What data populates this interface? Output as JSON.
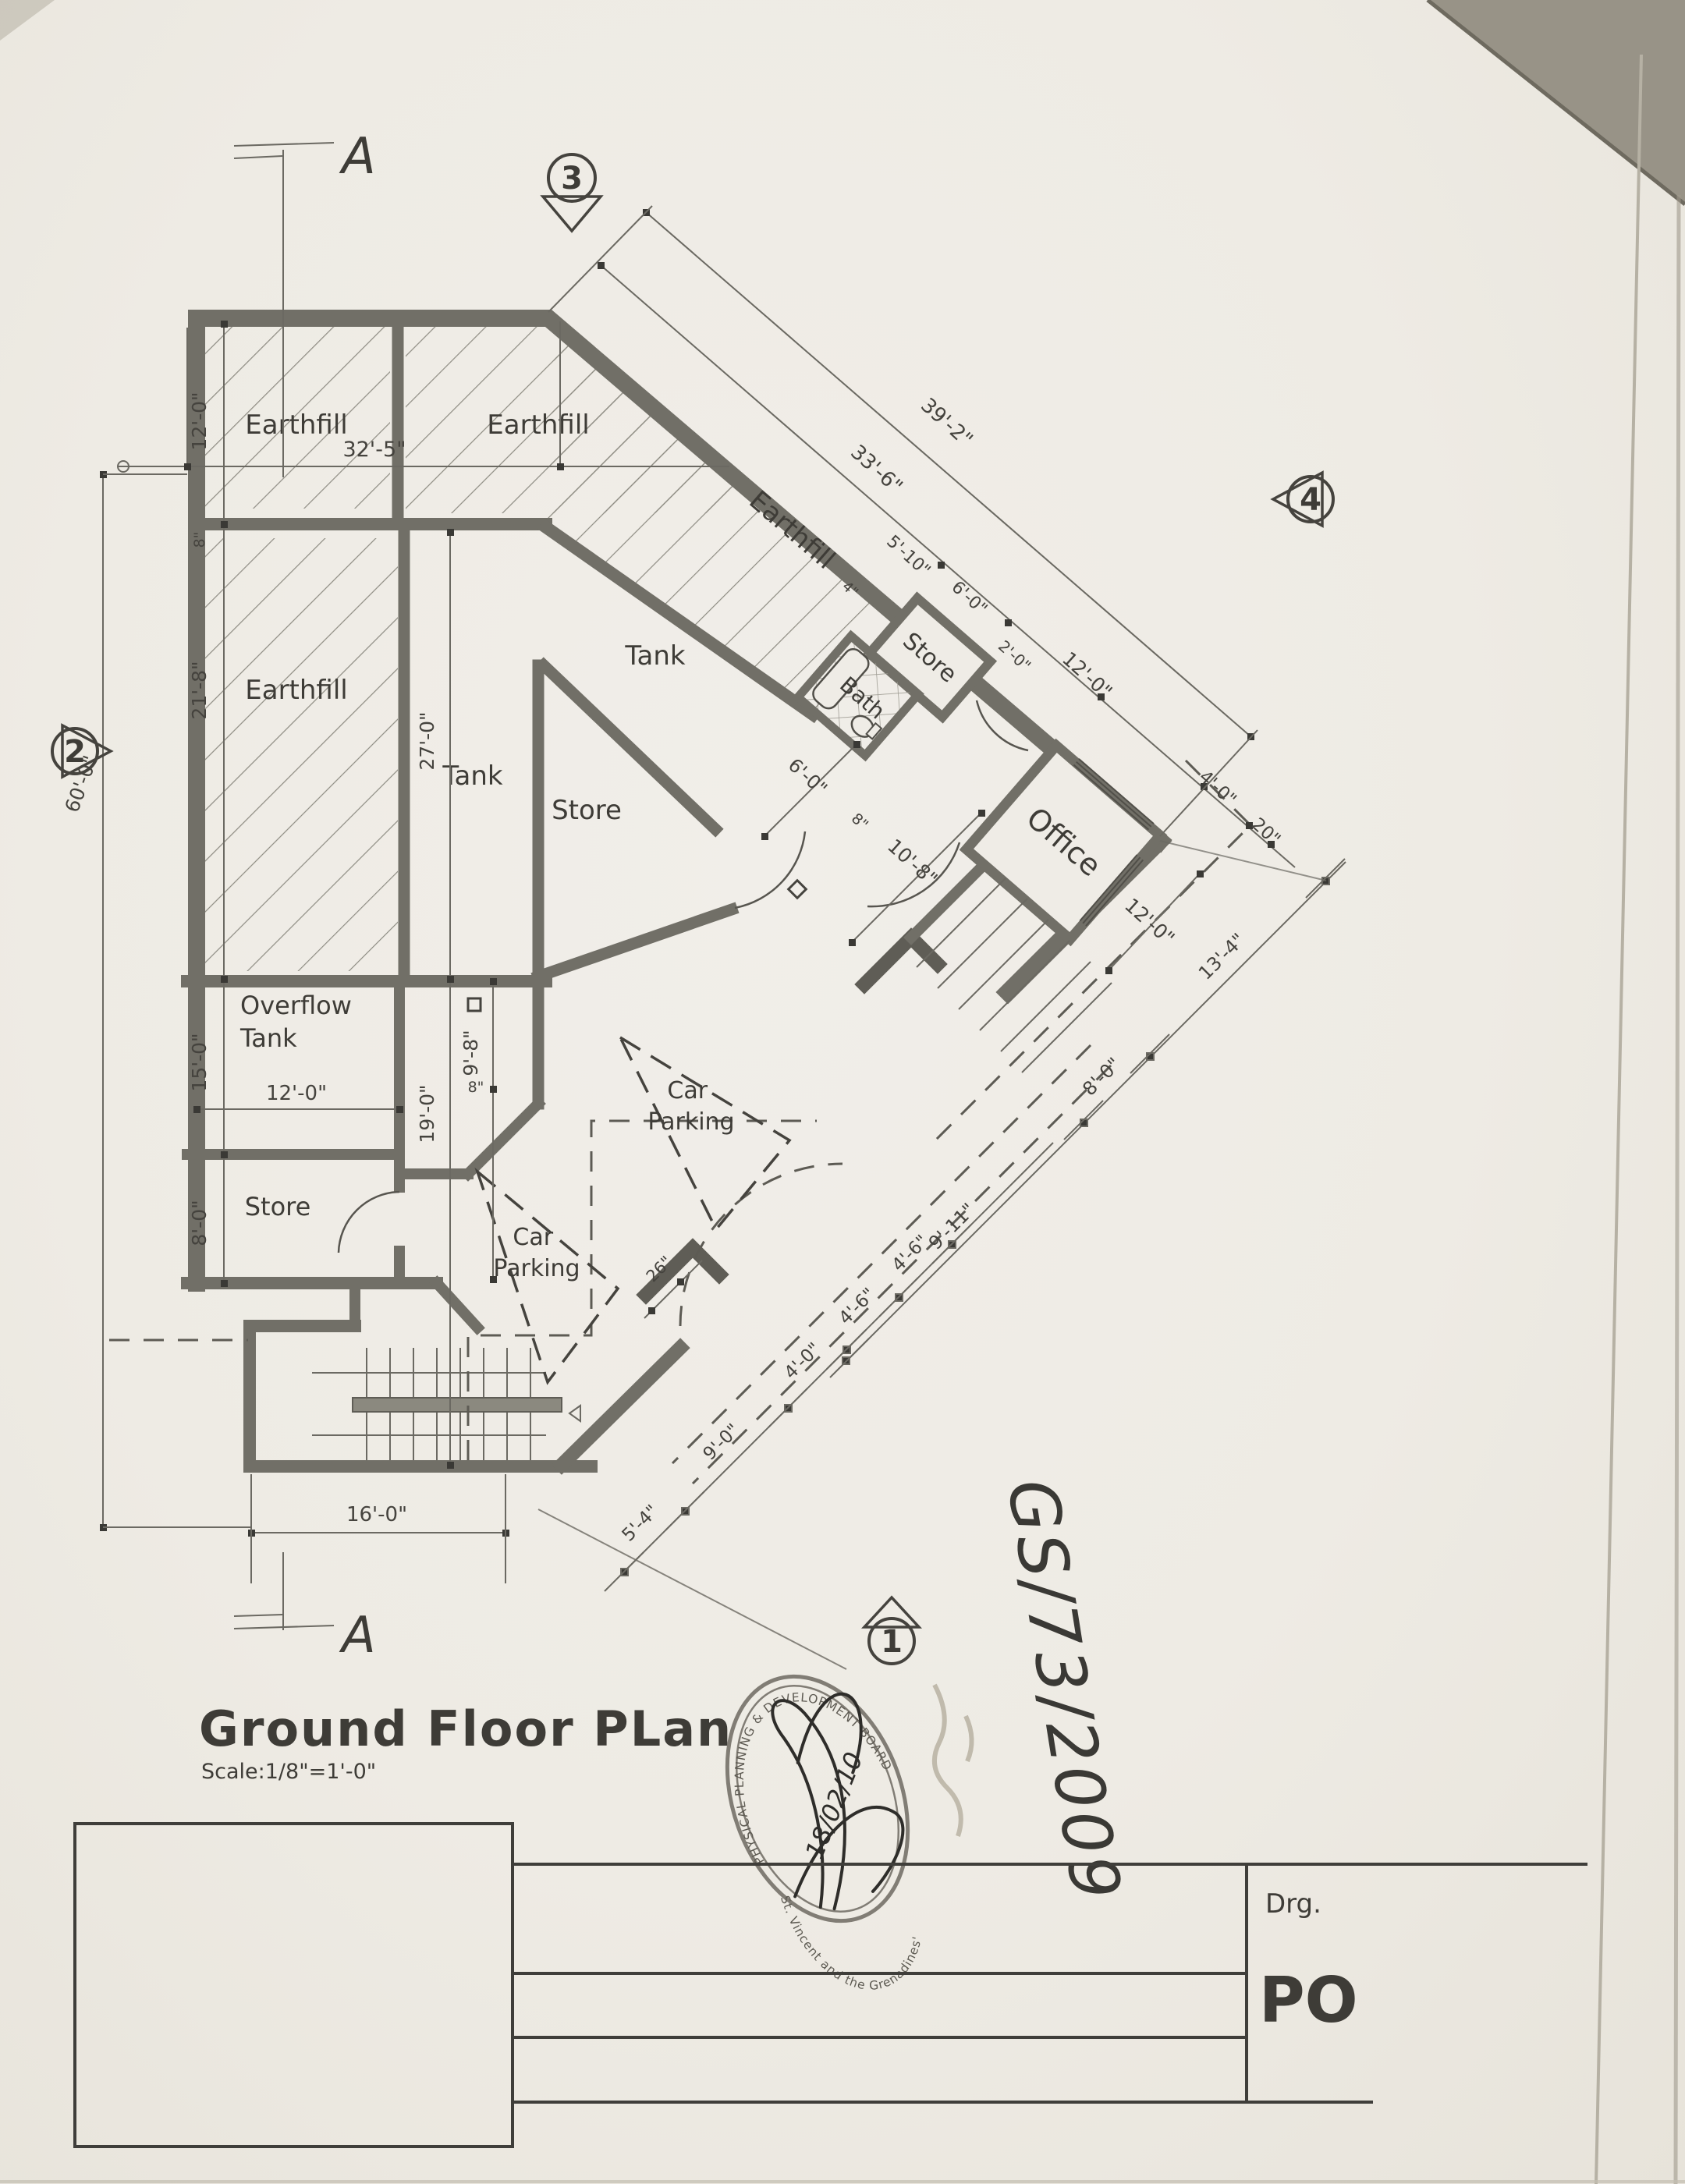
{
  "plan": {
    "title": "Ground Floor PLan",
    "scale": "Scale:1/8\"=1'-0\"",
    "rooms": {
      "earthfill_1": "Earthfill",
      "earthfill_2": "Earthfill",
      "earthfill_3": "Earthfill",
      "earthfill_wing": "Earthfill",
      "tank_main": "Tank",
      "tank_left": "Tank",
      "store_middle": "Store",
      "store_wing": "Store",
      "bath": "Bath",
      "office": "Office",
      "overflow_tank_line1": "Overflow",
      "overflow_tank_line2": "Tank",
      "store_lower": "Store",
      "car_parking_line1": "Car",
      "car_parking_line2": "Parking"
    },
    "dimensions": {
      "top_width": "32'-5\"",
      "room1_height": "12'-0\"",
      "room3_height": "21'-8\"",
      "left_total": "60'-0\"",
      "overflow_height": "15'-0\"",
      "overflow_width": "12'-0\"",
      "store_lower_height": "8'-0\"",
      "tank_height": "27'-0\"",
      "court_height": "19'-0\"",
      "court_offset": "9'-8\"",
      "stair_width": "16'-0\"",
      "wing_inner": "33'-6\"",
      "wing_outer": "39'-2\"",
      "wing_store_a": "5'-10\"",
      "wing_store_b": "6'-0\"",
      "bath_note": "4\"",
      "store_door": "2'-0\"",
      "office_ne": "12'-0\"",
      "office_se": "12'-0\"",
      "corner_a": "4'-0\"",
      "corner_b": "20\"",
      "hall_width": "6'-0\"",
      "entrance_width": "10'-8\"",
      "wall_8_a": "8\"",
      "wall_8_b": "8\"",
      "wall_8_c": "8\"",
      "pier_offset": "26\"",
      "chain_inner": [
        "5'-4\"",
        "9'-0\"",
        "4'-0\"",
        "4'-6\"",
        "4'-6\""
      ],
      "chain_outer": [
        "9'-11\"",
        "8'-0\"",
        "13'-4\""
      ]
    },
    "grid_markers": {
      "m1": "1",
      "m2": "2",
      "m3": "3",
      "m4": "4"
    },
    "section_marker": "A",
    "stamp": {
      "arc_top": "PHYSICAL PLANNING & DEVELOPMENT BOARD",
      "arc_bottom": "St. Vincent and the Grenadines'",
      "date": "18/02/10"
    },
    "annotations": {
      "file_number": "GS/73/2009"
    },
    "title_block": {
      "drg_label": "Drg.",
      "drawing_number_partial": "PO"
    }
  },
  "colors": {
    "paper": "#eeebe4",
    "ink": "#45433e",
    "wall": "#716f67",
    "pen": "#2e2d2a"
  }
}
